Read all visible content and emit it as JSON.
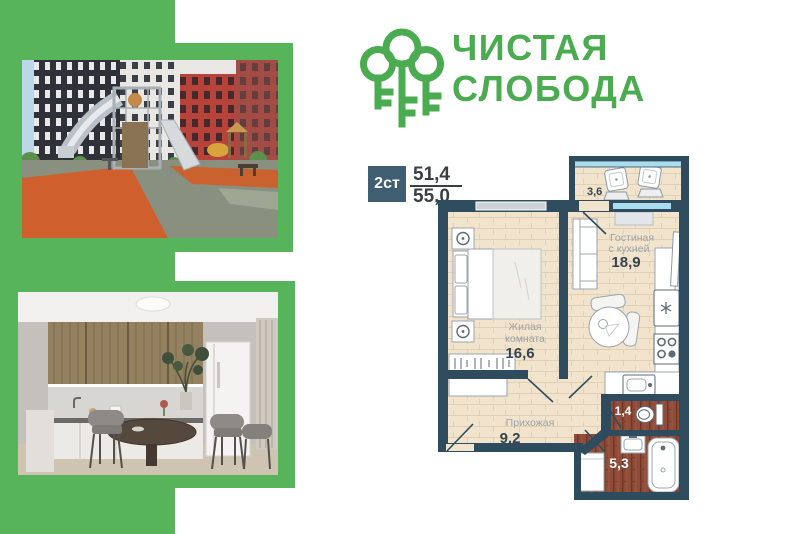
{
  "brand": {
    "name_line1": "ЧИСТАЯ",
    "name_line2": "СЛОБОДА",
    "green": "#4aab50",
    "logo_icon": "three-keys-trees-icon"
  },
  "spec": {
    "plan_type": "2ст",
    "area_top": "51,4",
    "area_bottom": "55,0"
  },
  "floorplan": {
    "living": {
      "name1": "Гостиная",
      "name2": "с кухней",
      "area": "18,9"
    },
    "bedroom": {
      "name1": "Жилая",
      "name2": "комната",
      "area": "16,6"
    },
    "hall": {
      "name": "Прихожая",
      "area": "9,2"
    },
    "balcony": {
      "area": "3,6"
    },
    "wc": {
      "area": "1,4"
    },
    "bathroom": {
      "area": "5,3"
    },
    "colors": {
      "wall": "#2e4c5e",
      "floor": "#f2e4cc",
      "wet_floor": "#8e4c39",
      "glass": "#aadcee",
      "accent_green": "#58b45a"
    }
  }
}
